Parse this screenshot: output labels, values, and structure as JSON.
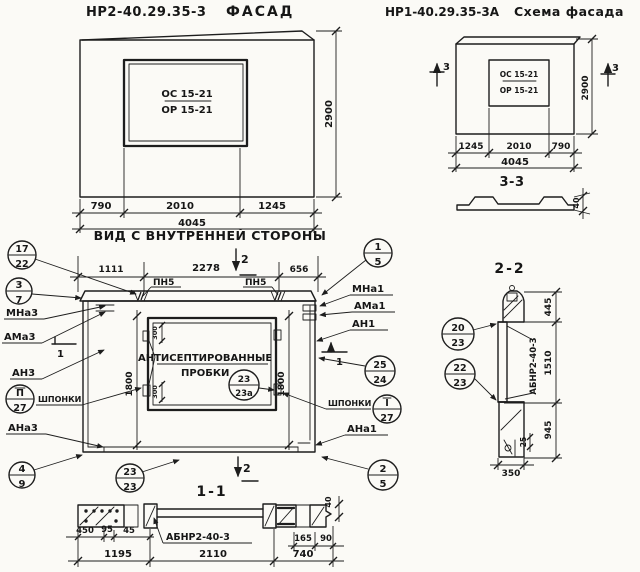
{
  "facade": {
    "code": "НР2-40.29.35-3",
    "title": "ФАСАД",
    "window_top": "ОС 15-21",
    "window_bottom": "ОР 15-21",
    "dim_left": "790",
    "dim_mid": "2010",
    "dim_right": "1245",
    "dim_total": "4045",
    "dim_height": "2900"
  },
  "schema": {
    "code": "НР1-40.29.35-3А",
    "title": "Схема фасада",
    "window_top": "ОС 15-21",
    "window_bottom": "ОР 15-21",
    "marker_left": "3",
    "marker_right": "3",
    "dim_left": "1245",
    "dim_mid": "2010",
    "dim_right": "790",
    "dim_total": "4045",
    "dim_height": "2900",
    "s33_label": "3-3",
    "s33_thickness": "40"
  },
  "inner": {
    "title": "ВИД С ВНУТРЕННЕЙ СТОРОНЫ",
    "d1111": "1111",
    "d2278": "2278",
    "d656": "656",
    "marker_top": "2",
    "marker_bottom": "2",
    "marker_left": "1",
    "marker_right": "1",
    "pn5_left": "ПН5",
    "pn5_right": "ПН5",
    "d1800_left": "1800",
    "d1800_right": "1800",
    "d300_top": "300",
    "d300_bottom": "300",
    "note1": "АНТИСЕПТИРОВАННЫЕ",
    "note2": "ПРОБКИ",
    "shponki_left": "ШПОНКИ",
    "shponki_right": "ШПОНКИ"
  },
  "left_labels": {
    "mna3": "МНа3",
    "ama3": "АМа3",
    "an3": "АН3",
    "ana3": "АНа3"
  },
  "right_labels": {
    "mna1": "МНа1",
    "ama1": "АМа1",
    "an1": "АН1",
    "ana1": "АНа1"
  },
  "callouts": {
    "k17_22": {
      "top": "17",
      "bottom": "22"
    },
    "k3_7": {
      "top": "3",
      "bottom": "7"
    },
    "kII_27": {
      "top": "П",
      "bottom": "27"
    },
    "k4_9": {
      "top": "4",
      "bottom": "9"
    },
    "k23_23": {
      "top": "23",
      "bottom": "23"
    },
    "k23_23a": {
      "top": "23",
      "bottom": "23а"
    },
    "k1_5": {
      "top": "1",
      "bottom": "5"
    },
    "k25_24": {
      "top": "25",
      "bottom": "24"
    },
    "kI_27": {
      "top": "I",
      "bottom": "27"
    },
    "k2_5": {
      "top": "2",
      "bottom": "5"
    },
    "k20_23": {
      "top": "20",
      "bottom": "23"
    },
    "k22_23": {
      "top": "22",
      "bottom": "23"
    }
  },
  "s11": {
    "label": "1-1",
    "code": "АБНР2-40-3",
    "d450": "450",
    "d95": "95",
    "d45": "45",
    "d1195": "1195",
    "d2110": "2110",
    "d740": "740",
    "d165": "165",
    "d90": "90",
    "d40": "40"
  },
  "s22": {
    "label": "2-2",
    "code": "АБНР2-40-3",
    "d445": "445",
    "d1510": "1510",
    "d945": "945",
    "d25": "25",
    "d350": "350"
  }
}
